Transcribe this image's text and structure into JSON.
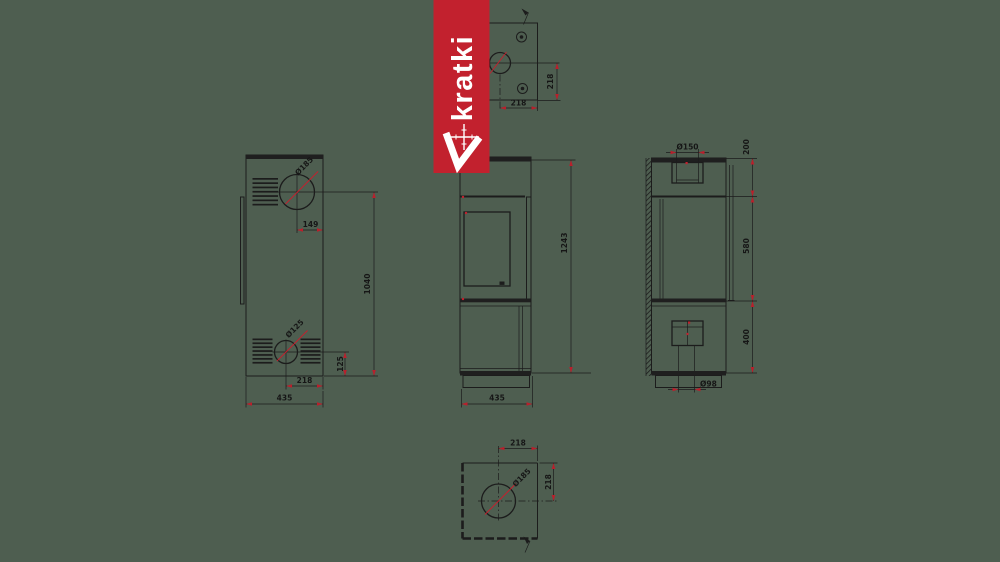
{
  "title": "kratki stove technical drawing",
  "canvas": {
    "background": "#4e5e50",
    "line_color": "#1c1c1c",
    "accent_color": "#c2212e"
  },
  "brand_banner": {
    "text": "kratki",
    "background": "#c2212e",
    "text_color": "#ffffff",
    "logo": "kratki-check-crosshair"
  },
  "views": {
    "top_view": {
      "width_mm": "218",
      "depth_mm": "218"
    },
    "back_view": {
      "flue_diameter": "Ø185",
      "flue_offset": "149",
      "outlet_span": "1040",
      "inlet_diameter": "Ø125",
      "inlet_height": "125",
      "inlet_offset": "218",
      "base_width": "435"
    },
    "front_view": {
      "total_height": "1243",
      "base_width": "435"
    },
    "side_view": {
      "flue_diameter": "Ø150",
      "top_section": "200",
      "middle_section": "580",
      "bottom_section": "400",
      "air_inlet_diameter": "Ø98"
    },
    "bottom_view": {
      "opening_diameter": "Ø185",
      "center_offset_x": "218",
      "center_offset_y": "218"
    }
  }
}
